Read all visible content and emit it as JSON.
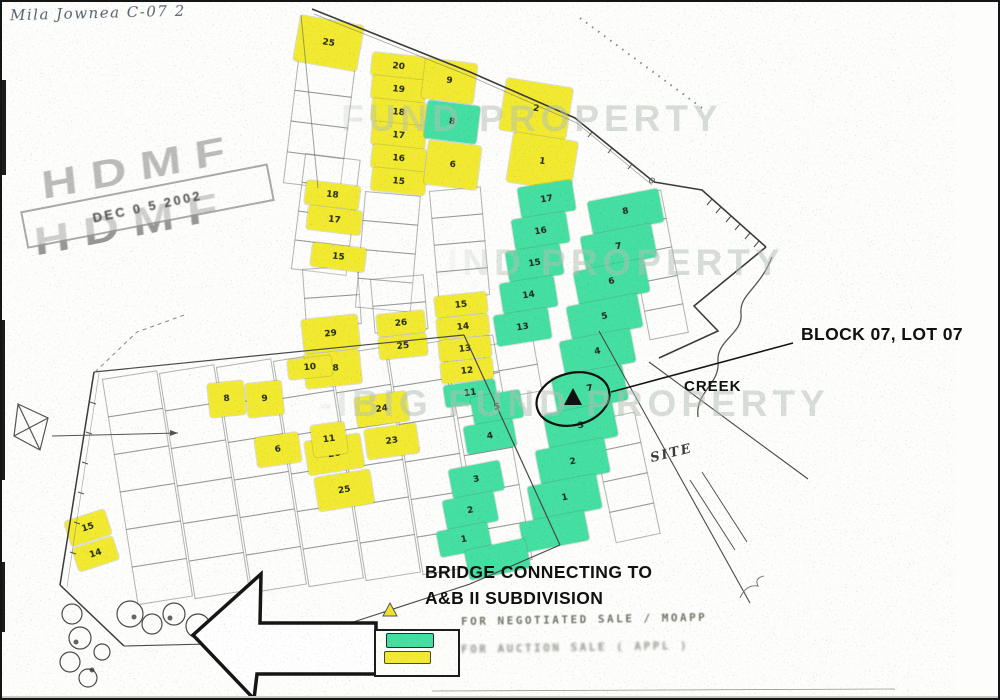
{
  "annotations": {
    "handwritten_note": "Mila Jownea C-07 2",
    "stamp_letters": "HDMF",
    "stamp_date": "DEC 0 5 2002",
    "block_lot_label": "BLOCK 07, LOT 07",
    "creek_label": "CREEK",
    "site_label": "SITE",
    "bridge_label_line1": "BRIDGE CONNECTING TO",
    "bridge_label_line2": "A&B II SUBDIVISION"
  },
  "watermark": {
    "text": "PAG-IBIG FUND PROPERTY",
    "color": "#b4c1b5"
  },
  "legend": {
    "negotiated_label": "FOR NEGOTIATED SALE / MOAPP",
    "auction_label": "FOR AUCTION SALE ( APPL )"
  },
  "map": {
    "colors": {
      "y": "#f2ea30",
      "g": "#45dfa2"
    },
    "lots": [
      {
        "x": 299,
        "y": 13,
        "w": 64,
        "h": 46,
        "r": 10,
        "c": "y",
        "t": "25"
      },
      {
        "x": 371,
        "y": 50,
        "w": 54,
        "h": 23,
        "r": 6,
        "c": "y",
        "t": "20"
      },
      {
        "x": 371,
        "y": 73,
        "w": 54,
        "h": 23,
        "r": 6,
        "c": "y",
        "t": "19"
      },
      {
        "x": 371,
        "y": 96,
        "w": 54,
        "h": 23,
        "r": 6,
        "c": "y",
        "t": "18"
      },
      {
        "x": 371,
        "y": 119,
        "w": 54,
        "h": 23,
        "r": 6,
        "c": "y",
        "t": "17"
      },
      {
        "x": 371,
        "y": 142,
        "w": 54,
        "h": 23,
        "r": 6,
        "c": "y",
        "t": "16"
      },
      {
        "x": 371,
        "y": 165,
        "w": 54,
        "h": 23,
        "r": 6,
        "c": "y",
        "t": "15"
      },
      {
        "x": 424,
        "y": 56,
        "w": 52,
        "h": 40,
        "r": 7,
        "c": "y",
        "t": "9"
      },
      {
        "x": 426,
        "y": 98,
        "w": 53,
        "h": 38,
        "r": 7,
        "c": "g",
        "t": "8"
      },
      {
        "x": 427,
        "y": 138,
        "w": 53,
        "h": 44,
        "r": 7,
        "c": "y",
        "t": "6"
      },
      {
        "x": 505,
        "y": 76,
        "w": 67,
        "h": 52,
        "r": 9,
        "c": "y",
        "t": "2"
      },
      {
        "x": 512,
        "y": 130,
        "w": 65,
        "h": 50,
        "r": 9,
        "c": "y",
        "t": "1"
      },
      {
        "x": 305,
        "y": 178,
        "w": 54,
        "h": 24,
        "r": 7,
        "c": "y",
        "t": "18"
      },
      {
        "x": 307,
        "y": 203,
        "w": 54,
        "h": 24,
        "r": 7,
        "c": "y",
        "t": "17"
      },
      {
        "x": 311,
        "y": 240,
        "w": 54,
        "h": 24,
        "r": 7,
        "c": "y",
        "t": "15"
      },
      {
        "x": 299,
        "y": 318,
        "w": 56,
        "h": 34,
        "r": -6,
        "c": "y",
        "t": "29"
      },
      {
        "x": 301,
        "y": 353,
        "w": 56,
        "h": 34,
        "r": -6,
        "c": "y",
        "t": "28"
      },
      {
        "x": 374,
        "y": 313,
        "w": 48,
        "h": 22,
        "r": -6,
        "c": "y",
        "t": "26"
      },
      {
        "x": 376,
        "y": 336,
        "w": 48,
        "h": 22,
        "r": -6,
        "c": "y",
        "t": "25"
      },
      {
        "x": 432,
        "y": 295,
        "w": 52,
        "h": 21,
        "r": -6,
        "c": "y",
        "t": "15"
      },
      {
        "x": 434,
        "y": 317,
        "w": 52,
        "h": 21,
        "r": -6,
        "c": "y",
        "t": "14"
      },
      {
        "x": 436,
        "y": 339,
        "w": 52,
        "h": 21,
        "r": -6,
        "c": "y",
        "t": "13"
      },
      {
        "x": 438,
        "y": 361,
        "w": 52,
        "h": 21,
        "r": -6,
        "c": "y",
        "t": "12"
      },
      {
        "x": 441,
        "y": 384,
        "w": 52,
        "h": 22,
        "r": -8,
        "c": "g",
        "t": "11"
      },
      {
        "x": 352,
        "y": 396,
        "w": 52,
        "h": 30,
        "r": -8,
        "c": "y",
        "t": "24"
      },
      {
        "x": 362,
        "y": 428,
        "w": 52,
        "h": 30,
        "r": -8,
        "c": "y",
        "t": "23"
      },
      {
        "x": 302,
        "y": 440,
        "w": 56,
        "h": 34,
        "r": -9,
        "c": "y",
        "t": "26"
      },
      {
        "x": 312,
        "y": 476,
        "w": 56,
        "h": 34,
        "r": -9,
        "c": "y",
        "t": "25"
      },
      {
        "x": 205,
        "y": 382,
        "w": 36,
        "h": 34,
        "r": -6,
        "c": "y",
        "t": "8"
      },
      {
        "x": 243,
        "y": 382,
        "w": 36,
        "h": 34,
        "r": -6,
        "c": "y",
        "t": "9"
      },
      {
        "x": 285,
        "y": 358,
        "w": 44,
        "h": 20,
        "r": -6,
        "c": "y",
        "t": "10"
      },
      {
        "x": 252,
        "y": 436,
        "w": 44,
        "h": 30,
        "r": -8,
        "c": "y",
        "t": "6"
      },
      {
        "x": 308,
        "y": 424,
        "w": 34,
        "h": 32,
        "r": -8,
        "c": "y",
        "t": "11"
      },
      {
        "x": 62,
        "y": 520,
        "w": 42,
        "h": 26,
        "r": -18,
        "c": "y",
        "t": "15"
      },
      {
        "x": 70,
        "y": 547,
        "w": 42,
        "h": 24,
        "r": -18,
        "c": "y",
        "t": "14"
      },
      {
        "x": 515,
        "y": 186,
        "w": 55,
        "h": 31,
        "r": -9,
        "c": "g",
        "t": "17"
      },
      {
        "x": 509,
        "y": 218,
        "w": 55,
        "h": 31,
        "r": -9,
        "c": "g",
        "t": "16"
      },
      {
        "x": 503,
        "y": 250,
        "w": 55,
        "h": 31,
        "r": -9,
        "c": "g",
        "t": "15"
      },
      {
        "x": 497,
        "y": 282,
        "w": 55,
        "h": 31,
        "r": -9,
        "c": "g",
        "t": "14"
      },
      {
        "x": 491,
        "y": 314,
        "w": 55,
        "h": 31,
        "r": -9,
        "c": "g",
        "t": "13"
      },
      {
        "x": 468,
        "y": 396,
        "w": 50,
        "h": 28,
        "r": -10,
        "c": "g",
        "t": "5"
      },
      {
        "x": 461,
        "y": 425,
        "w": 50,
        "h": 28,
        "r": -10,
        "c": "g",
        "t": "4"
      },
      {
        "x": 446,
        "y": 468,
        "w": 52,
        "h": 30,
        "r": -11,
        "c": "g",
        "t": "3"
      },
      {
        "x": 440,
        "y": 499,
        "w": 52,
        "h": 30,
        "r": -11,
        "c": "g",
        "t": "2"
      },
      {
        "x": 434,
        "y": 530,
        "w": 52,
        "h": 26,
        "r": -11,
        "c": "g",
        "t": "1"
      },
      {
        "x": 585,
        "y": 200,
        "w": 72,
        "h": 34,
        "r": -11,
        "c": "g",
        "t": "8"
      },
      {
        "x": 578,
        "y": 235,
        "w": 72,
        "h": 34,
        "r": -11,
        "c": "g",
        "t": "7"
      },
      {
        "x": 571,
        "y": 270,
        "w": 72,
        "h": 34,
        "r": -11,
        "c": "g",
        "t": "6"
      },
      {
        "x": 564,
        "y": 305,
        "w": 72,
        "h": 34,
        "r": -11,
        "c": "g",
        "t": "5"
      },
      {
        "x": 557,
        "y": 340,
        "w": 72,
        "h": 34,
        "r": -11,
        "c": "g",
        "t": "4"
      },
      {
        "x": 549,
        "y": 376,
        "w": 72,
        "h": 36,
        "r": -11,
        "c": "g",
        "t": "7"
      },
      {
        "x": 541,
        "y": 413,
        "w": 70,
        "h": 35,
        "r": -11,
        "c": "g",
        "t": "3"
      },
      {
        "x": 533,
        "y": 449,
        "w": 70,
        "h": 35,
        "r": -11,
        "c": "g",
        "t": "2"
      },
      {
        "x": 525,
        "y": 485,
        "w": 70,
        "h": 35,
        "r": -11,
        "c": "g",
        "t": "1"
      },
      {
        "x": 517,
        "y": 521,
        "w": 66,
        "h": 30,
        "r": -11,
        "c": "g",
        "t": ""
      },
      {
        "x": 462,
        "y": 549,
        "w": 62,
        "h": 30,
        "r": -12,
        "c": "g",
        "t": ""
      }
    ],
    "strips": [
      {
        "x": 296,
        "y": 58,
        "w": 58,
        "h": 30,
        "n": 4,
        "r": 7
      },
      {
        "x": 303,
        "y": 152,
        "w": 56,
        "h": 28,
        "n": 4,
        "r": 7
      },
      {
        "x": 300,
        "y": 268,
        "w": 56,
        "h": 28,
        "n": 2,
        "r": -4
      },
      {
        "x": 363,
        "y": 190,
        "w": 56,
        "h": 28,
        "n": 4,
        "r": 5
      },
      {
        "x": 368,
        "y": 278,
        "w": 54,
        "h": 26,
        "n": 2,
        "r": -5
      },
      {
        "x": 427,
        "y": 190,
        "w": 52,
        "h": 26,
        "n": 4,
        "r": -5
      },
      {
        "x": 480,
        "y": 345,
        "w": 52,
        "h": 26,
        "n": 2,
        "r": -10
      },
      {
        "x": 620,
        "y": 196,
        "w": 40,
        "h": 28,
        "n": 5,
        "r": -11
      },
      {
        "x": 588,
        "y": 420,
        "w": 46,
        "h": 30,
        "n": 4,
        "r": -12
      },
      {
        "x": 100,
        "y": 378,
        "w": 56,
        "h": 37,
        "n": 6,
        "r": -9
      },
      {
        "x": 157,
        "y": 372,
        "w": 56,
        "h": 37,
        "n": 6,
        "r": -9
      },
      {
        "x": 214,
        "y": 366,
        "w": 56,
        "h": 37,
        "n": 6,
        "r": -9
      },
      {
        "x": 271,
        "y": 360,
        "w": 56,
        "h": 37,
        "n": 6,
        "r": -9
      },
      {
        "x": 328,
        "y": 354,
        "w": 56,
        "h": 37,
        "n": 6,
        "r": -9
      },
      {
        "x": 385,
        "y": 348,
        "w": 56,
        "h": 37,
        "n": 6,
        "r": -9
      },
      {
        "x": 442,
        "y": 342,
        "w": 50,
        "h": 37,
        "n": 6,
        "r": -10
      }
    ]
  }
}
